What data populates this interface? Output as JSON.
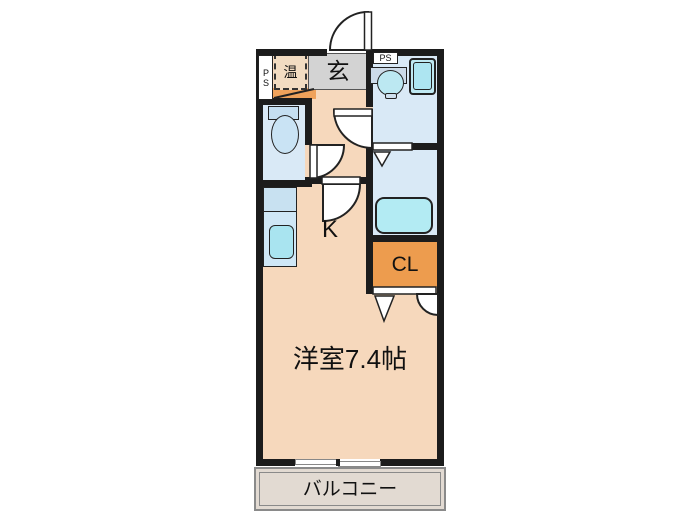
{
  "plan": {
    "type": "apartment-floor-plan",
    "labels": {
      "ps_left": "PS",
      "ps_right": "PS",
      "water_heater": "温",
      "entrance": "玄",
      "kitchen": "K",
      "closet": "CL",
      "main_room": "洋室7.4帖",
      "balcony": "バルコニー"
    }
  },
  "colors": {
    "floor": "#f6d8bc",
    "step": "#d3d3d3",
    "tataki": "#efa25b",
    "closet": "#ed9c4e",
    "wet": "#d9e9f6",
    "fixture": "#c5dff1",
    "sink": "#a9e4f0",
    "tub": "#b3ebf3",
    "wall": "#1c1c1c",
    "balcony_bg": "#e2dad2",
    "balcony_line": "#8a8a8a",
    "outline": "#222222",
    "white": "#ffffff",
    "text": "#111111"
  }
}
